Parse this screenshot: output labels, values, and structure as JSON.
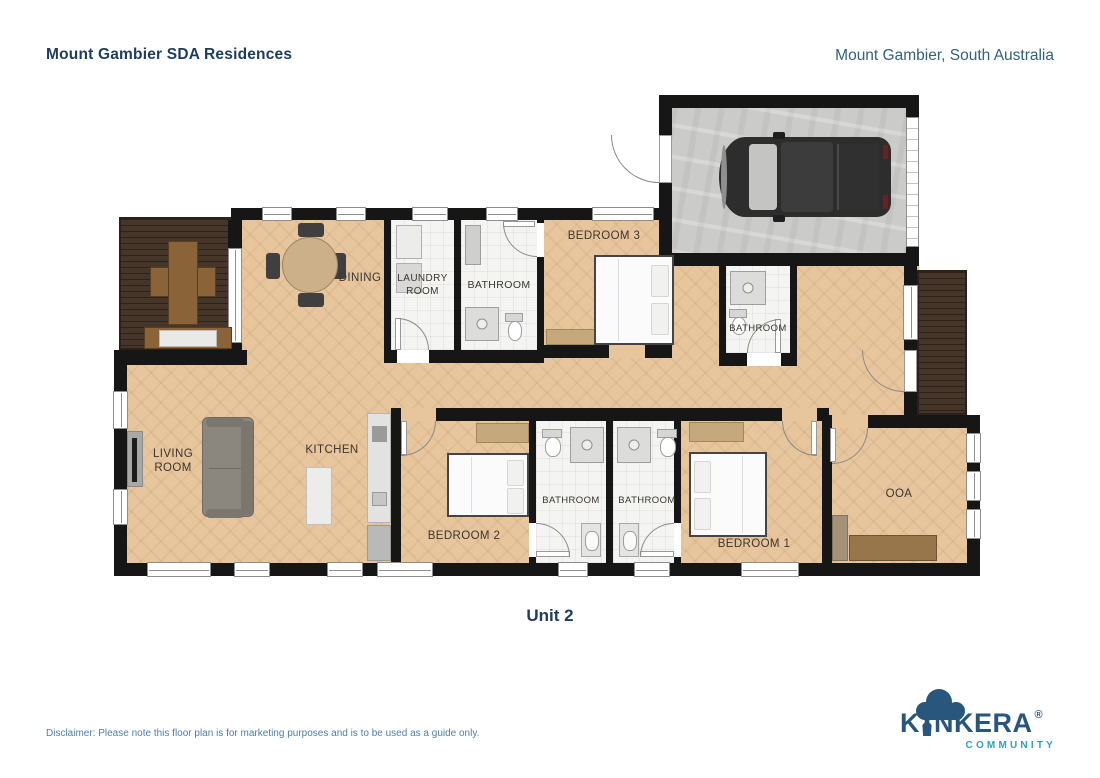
{
  "header": {
    "title": "Mount Gambier SDA Residences",
    "location": "Mount Gambier, South Australia"
  },
  "plan": {
    "unit_label": "Unit 2",
    "rooms": [
      {
        "id": "dining",
        "label": "DINING"
      },
      {
        "id": "laundry",
        "label": "LAUNDRY ROOM"
      },
      {
        "id": "bathroom-top",
        "label": "BATHROOM"
      },
      {
        "id": "bedroom-3",
        "label": "BEDROOM 3"
      },
      {
        "id": "bathroom-mid",
        "label": "BATHROOM"
      },
      {
        "id": "living-room",
        "label": "LIVING ROOM"
      },
      {
        "id": "kitchen",
        "label": "KITCHEN"
      },
      {
        "id": "bedroom-2",
        "label": "BEDROOM 2"
      },
      {
        "id": "bathroom-ensuite-left",
        "label": "BATHROOM"
      },
      {
        "id": "bathroom-ensuite-right",
        "label": "BATHROOM"
      },
      {
        "id": "bedroom-1",
        "label": "BEDROOM 1"
      },
      {
        "id": "ooa",
        "label": "OOA"
      }
    ]
  },
  "footer": {
    "disclaimer": "Disclaimer: Please note this floor plan is for marketing purposes and is to be used as a guide only."
  },
  "logo": {
    "prefix": "K",
    "suffix": "NKERA",
    "registered": "®",
    "subtitle": "COMMUNITY"
  },
  "colors": {
    "navy": "#1e3c5f",
    "steel_blue": "#33617f",
    "disclaimer_blue": "#4d7fa8",
    "logo_navy": "#29567d",
    "logo_teal": "#2ba3bd",
    "wall": "#161616",
    "wood": "#e7c69e",
    "deck": "#46362a",
    "tile": "#f4f4f2",
    "concrete": "#cbcbc9",
    "label": "#3c362e"
  }
}
